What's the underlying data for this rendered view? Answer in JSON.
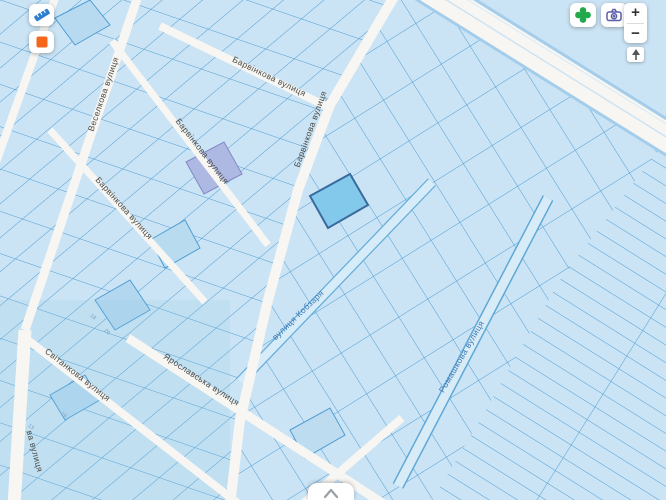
{
  "controls": {
    "top_left": [
      {
        "name": "measure-tool",
        "icon": "ruler-icon",
        "icon_color": "#2d7fd0"
      },
      {
        "name": "rectangle-tool",
        "icon": "orange-square-icon",
        "icon_color": "#f4661b"
      }
    ],
    "top_right": [
      {
        "name": "layers",
        "icon": "clover-icon",
        "icon_color": "#21a94c"
      },
      {
        "name": "street-view",
        "icon": "camera-icon",
        "icon_color": "#5b5fa8"
      }
    ],
    "zoom": {
      "zoom_in": "+",
      "zoom_out": "−",
      "reset_north_icon": "north-arrow-icon"
    },
    "bottom_drawer_icon": "chevron-up-icon"
  },
  "map": {
    "colors": {
      "parcel_fill": "#cbe4f5",
      "parcel_line": "#4f9dd3",
      "street_fill": "#f8f6f2",
      "road_casing": "#a3cdea",
      "selected_fill": "#83c9eb",
      "selected_stroke": "#3a6b9e",
      "label_gray": "#4a4a45",
      "label_blue": "#3f7ab3"
    },
    "selected_parcel": {
      "points": "310,196 350,174 368,205 328,228"
    },
    "street_labels": [
      {
        "text": "Веселкова вулиця",
        "x": 106,
        "y": 95,
        "angle": -71,
        "color": "#4a4a45"
      },
      {
        "text": "Барвінкова вулиця",
        "x": 268,
        "y": 79,
        "angle": 26,
        "color": "#4a4a45"
      },
      {
        "text": "Барвінкова вулиця",
        "x": 200,
        "y": 153,
        "angle": 52,
        "color": "#4a4a45"
      },
      {
        "text": "Барвінкова вулиця",
        "x": 122,
        "y": 210,
        "angle": 48,
        "color": "#4a4a45"
      },
      {
        "text": "Барвінкова вулиця",
        "x": 313,
        "y": 130,
        "angle": -70,
        "color": "#4a4a45"
      },
      {
        "text": "вулиця Кобзаря",
        "x": 300,
        "y": 317,
        "angle": -44,
        "color": "#3f7ab3"
      },
      {
        "text": "Ромашкова вулиця",
        "x": 464,
        "y": 358,
        "angle": -60,
        "color": "#3f7ab3"
      },
      {
        "text": "Ярославська вулиця",
        "x": 200,
        "y": 382,
        "angle": 33,
        "color": "#4a4a45"
      },
      {
        "text": "Світанкова вулиця",
        "x": 76,
        "y": 377,
        "angle": 38,
        "color": "#4a4a45"
      },
      {
        "text": "ва вулиця",
        "x": 32,
        "y": 452,
        "angle": 75,
        "color": "#4a4a45"
      }
    ],
    "parcel_numbers": [
      {
        "text": "18",
        "x": 92,
        "y": 318,
        "angle": 40
      },
      {
        "text": "20",
        "x": 106,
        "y": 333,
        "angle": 40
      },
      {
        "text": "16",
        "x": 63,
        "y": 416,
        "angle": 40
      },
      {
        "text": "13",
        "x": 30,
        "y": 428,
        "angle": 40
      }
    ]
  }
}
